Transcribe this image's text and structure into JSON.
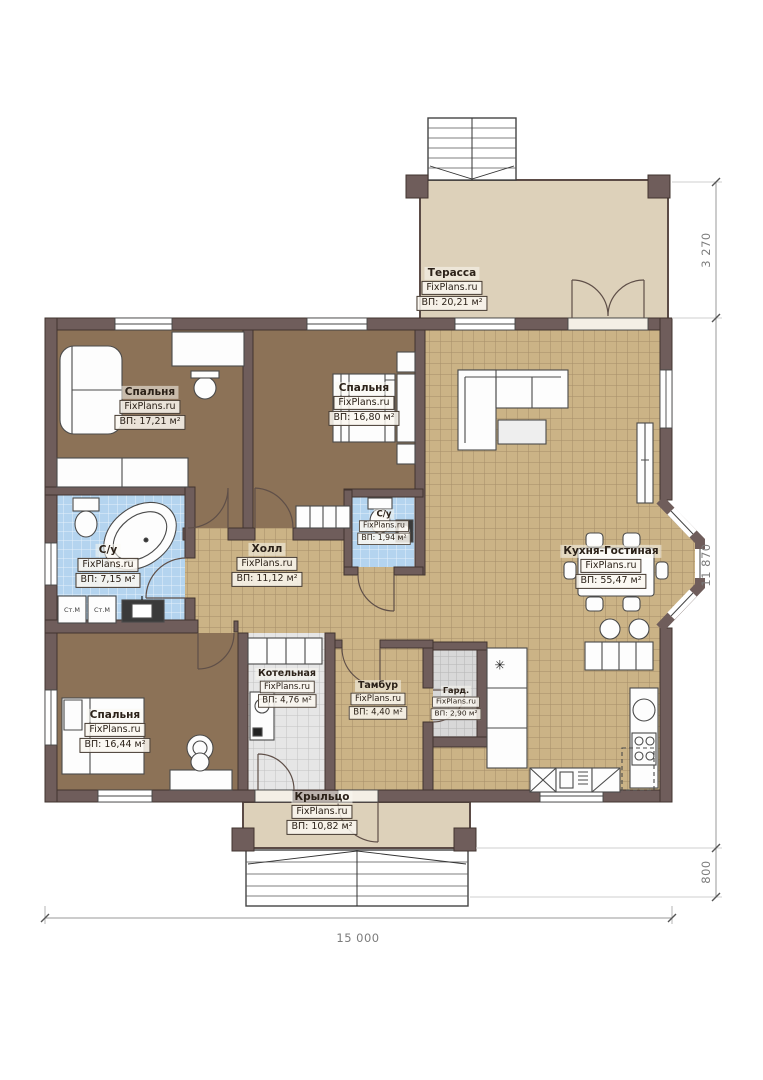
{
  "watermark": "FixPlans.ru",
  "rooms": {
    "terrace": {
      "name": "Терасса",
      "watermark": "FixPlans.ru",
      "area": "ВП: 20,21 м²"
    },
    "bedroom1": {
      "name": "Спальня",
      "watermark": "FixPlans.ru",
      "area": "ВП: 17,21 м²"
    },
    "bedroom2": {
      "name": "Спальня",
      "watermark": "FixPlans.ru",
      "area": "ВП: 16,80 м²"
    },
    "wc_small": {
      "name": "С/у",
      "watermark": "FixPlans.ru",
      "area": "ВП: 1,94 м²"
    },
    "bathroom": {
      "name": "С/у",
      "watermark": "FixPlans.ru",
      "area": "ВП: 7,15 м²"
    },
    "hall": {
      "name": "Холл",
      "watermark": "FixPlans.ru",
      "area": "ВП: 11,12 м²"
    },
    "kitchen": {
      "name": "Кухня-Гостиная",
      "watermark": "FixPlans.ru",
      "area": "ВП: 55,47 м²"
    },
    "boiler": {
      "name": "Котельная",
      "watermark": "FixPlans.ru",
      "area": "ВП: 4,76 м²"
    },
    "tambour": {
      "name": "Тамбур",
      "watermark": "FixPlans.ru",
      "area": "ВП: 4,40 м²"
    },
    "wardrobe": {
      "name": "Гард.",
      "watermark": "FixPlans.ru",
      "area": "ВП: 2,90 м²"
    },
    "bedroom3": {
      "name": "Спальня",
      "watermark": "FixPlans.ru",
      "area": "ВП: 16,44 м²"
    },
    "porch": {
      "name": "Крыльцо",
      "watermark": "FixPlans.ru",
      "area": "ВП: 10,82 м²"
    }
  },
  "appliances": {
    "washing_machine": "Ст.М",
    "fridge_symbol": "✳"
  },
  "dimensions": {
    "total_width": "15 000",
    "terrace_depth": "3 270",
    "house_depth": "11 870",
    "porch_depth": "800"
  },
  "colors": {
    "wall": "#6f5d5b",
    "bedroom_floor": "#8c7257",
    "tile_tan": "#cbb386",
    "tile_blue": "#b4d4ef",
    "terrace": "#ddd1ba"
  }
}
